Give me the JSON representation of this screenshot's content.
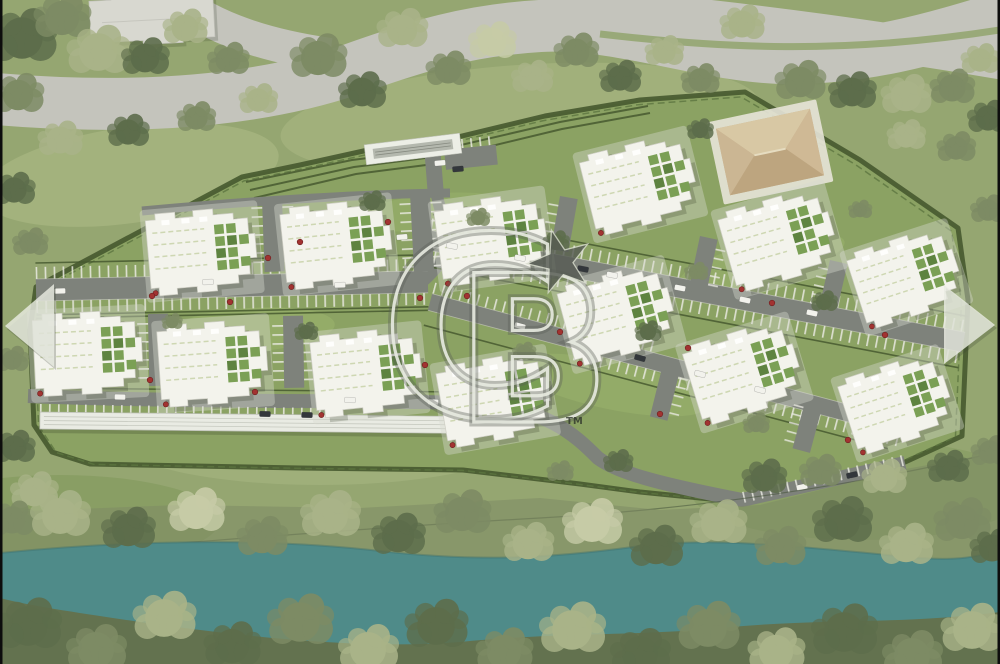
{
  "watermark": {
    "letter_c": "C",
    "letter_b": "B",
    "trademark": "TM"
  },
  "carousel": {
    "prev_icon": "left-triangle",
    "next_icon": "right-triangle"
  },
  "scene": {
    "type": "aerial-3d-render-site-plan",
    "building_count": 13
  },
  "colors": {
    "grass": "#95a671",
    "grass_light": "#b3c08b",
    "grass_dark": "#74904e",
    "site": "#8ba263",
    "lawn": "#9db66e",
    "river": "#4f8b89",
    "road_public": "#c4c4bc",
    "road_site": "#7e827b",
    "parking_tick": "#e9e9e1",
    "building": "#f3f3ec",
    "building_edge": "#cfcfc5",
    "courtyard": "#7ba055",
    "hedge": "#46592f",
    "tree_dark": "#5d6d4b",
    "tree_mid": "#7d8b64",
    "tree_light": "#a9b388",
    "tree_pale": "#c6cba6",
    "clubhouse": "#c8b28f",
    "carport": "#e9ebe3",
    "star": "#575c54",
    "watermark_light": "#e8ebe1",
    "watermark_dark": "#5a5f57",
    "arrow": "#e9ece2",
    "bush": "#a23331",
    "car_white": "#f2f2ec",
    "car_dark": "#33373b",
    "edge_bar": "#0d0d0d"
  }
}
